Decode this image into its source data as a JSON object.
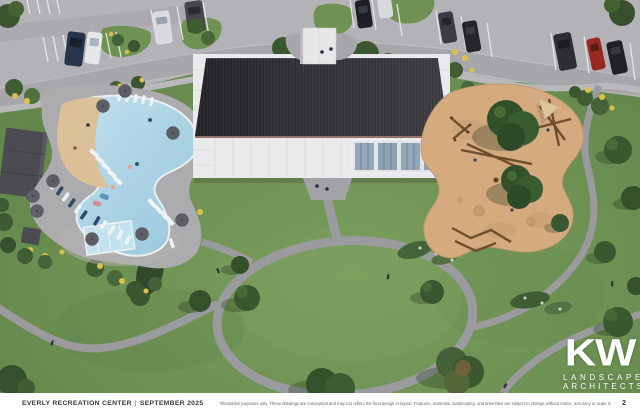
{
  "footer": {
    "project_title": "EVERLY RECREATION CENTER",
    "separator": "|",
    "date": "SEPTEMBER 2025",
    "disclaimer": "*Illustrative purposes only. These drawings are conceptual and may not reflect the final design or layout. Features, materials, landscaping, and amenities are subject to change without notice, accuracy or scale is not guaranteed.",
    "page_number": "2"
  },
  "logo": {
    "monogram": "KW",
    "line1": "LANDSCAPE",
    "line2": "ARCHITECTS"
  },
  "scene": {
    "type": "aerial-site-plan-rendering",
    "areas": [
      "parking-lot",
      "recreation-building",
      "entry-canopy",
      "resort-pool",
      "beach-entry",
      "lap-pool",
      "pool-cabana",
      "playground",
      "event-lawn",
      "loop-path"
    ],
    "colors": {
      "lawn": "#6d9053",
      "asphalt": "#b3b3b7",
      "path": "#9b9b9f",
      "roof": "#38383c",
      "building_white": "#eaeaec",
      "pool_water": "#aad2e3",
      "beach_entry_sand": "#dcc096",
      "playground_sand": "#d5aa7f",
      "tree_green": "#3a5830",
      "footer_background": "#fdfdfd"
    }
  }
}
